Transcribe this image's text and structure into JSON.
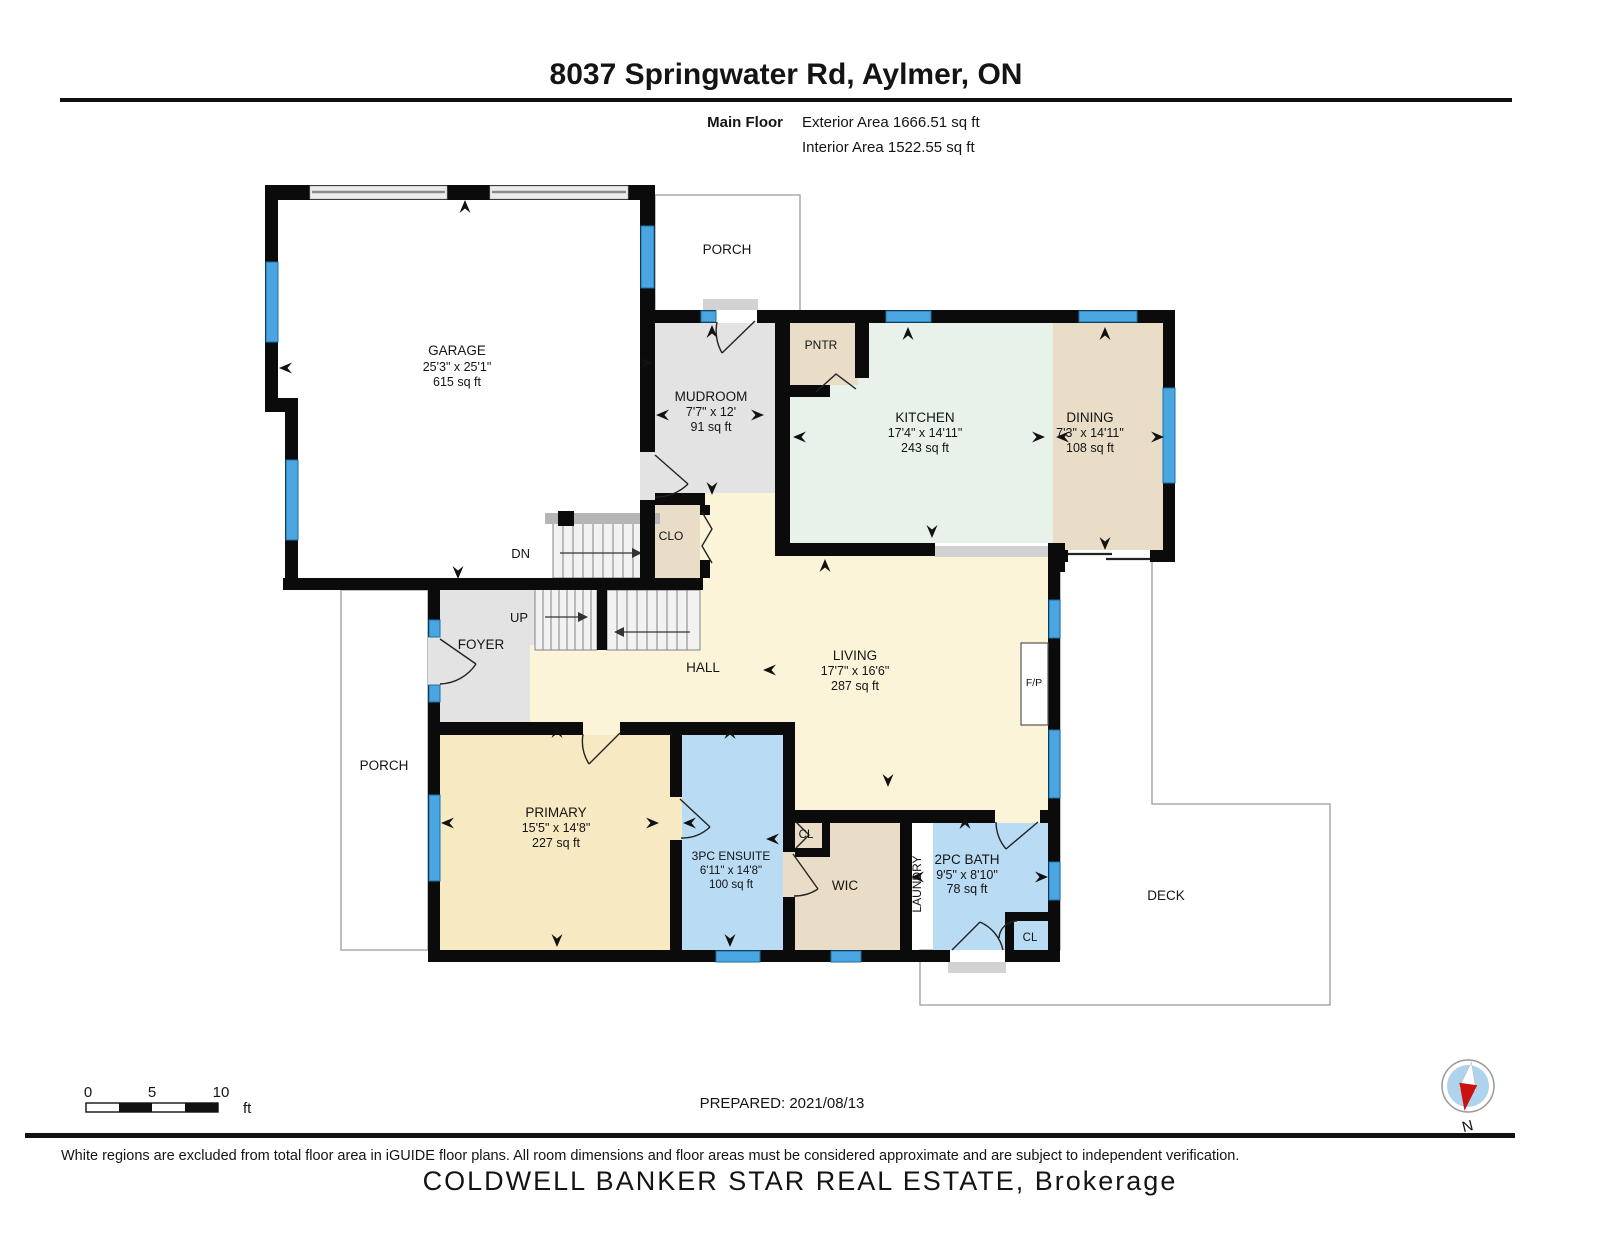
{
  "header": {
    "title": "8037 Springwater Rd, Aylmer, ON",
    "floor_label": "Main Floor",
    "exterior_area": "Exterior Area 1666.51 sq ft",
    "interior_area": "Interior Area 1522.55 sq ft"
  },
  "rooms": {
    "garage": {
      "name": "GARAGE",
      "dims": "25'3\" x 25'1\"",
      "area": "615 sq ft"
    },
    "porch_top": {
      "name": "PORCH"
    },
    "mudroom": {
      "name": "MUDROOM",
      "dims": "7'7\" x 12'",
      "area": "91 sq ft"
    },
    "pntr": {
      "name": "PNTR"
    },
    "kitchen": {
      "name": "KITCHEN",
      "dims": "17'4\" x 14'11\"",
      "area": "243 sq ft"
    },
    "dining": {
      "name": "DINING",
      "dims": "7'3\" x 14'11\"",
      "area": "108 sq ft"
    },
    "clo": {
      "name": "CLO"
    },
    "stairs": {
      "down": "DN",
      "up": "UP"
    },
    "foyer": {
      "name": "FOYER"
    },
    "hall": {
      "name": "HALL"
    },
    "living": {
      "name": "LIVING",
      "dims": "17'7\" x 16'6\"",
      "area": "287 sq ft"
    },
    "fireplace": {
      "name": "F/P"
    },
    "porch_left": {
      "name": "PORCH"
    },
    "primary": {
      "name": "PRIMARY",
      "dims": "15'5\" x 14'8\"",
      "area": "227 sq ft"
    },
    "ensuite": {
      "name": "3PC ENSUITE",
      "dims": "6'11\" x 14'8\"",
      "area": "100 sq ft"
    },
    "closet_hall": {
      "name": "CL"
    },
    "wic": {
      "name": "WIC"
    },
    "laundry": {
      "name": "LAUNDRY"
    },
    "bath": {
      "name": "2PC BATH",
      "dims": "9'5\" x 8'10\"",
      "area": "78 sq ft"
    },
    "closet_bath": {
      "name": "CL"
    },
    "deck": {
      "name": "DECK"
    }
  },
  "footer": {
    "scale": {
      "t0": "0",
      "t5": "5",
      "t10": "10",
      "unit": "ft"
    },
    "prepared": "PREPARED: 2021/08/13",
    "compass_label": "N",
    "disclaimer": "White regions are excluded from total floor area in iGUIDE floor plans. All room dimensions and floor areas must be considered approximate and are subject to independent verification.",
    "watermark": "COLDWELL BANKER STAR REAL ESTATE, Brokerage"
  },
  "colors": {
    "wall": "#0b0b0b",
    "gray_room": "#e3e3e3",
    "tan_room": "#e9ddc7",
    "mint_room": "#e9f2ea",
    "yellow_room": "#fcf4d8",
    "yellow_room_deep": "#f7eac2",
    "blue_room": "#b9dcf4",
    "window": "#4aa6e0",
    "step": "#d2d2d2",
    "stair_dark": "#b5b5b5",
    "compass_blue": "#aed3ec",
    "compass_red": "#cc1111",
    "watermark": "#c9c9c9"
  }
}
